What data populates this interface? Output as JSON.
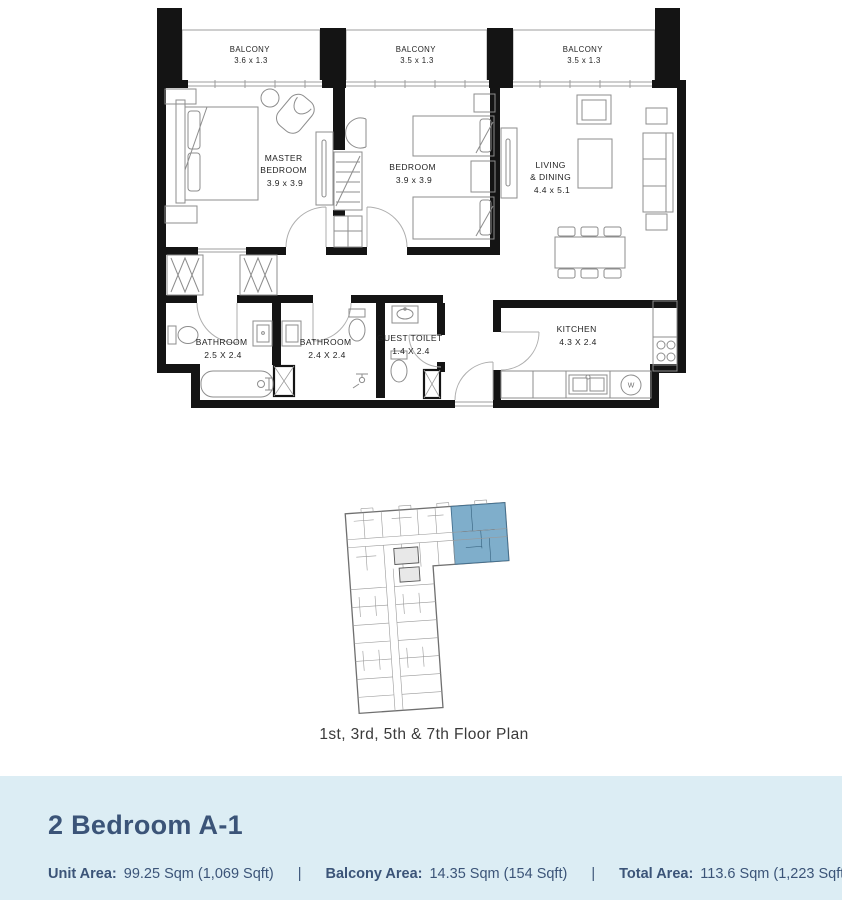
{
  "colors": {
    "footer_bg": "#DCEDF4",
    "navy": "#3B5478",
    "highlight": "#7FAECB",
    "wall": "#141414",
    "furniture": "#8D8D8D",
    "label": "#1F1F1F"
  },
  "floor_plan": {
    "balconies": [
      {
        "name": "BALCONY",
        "dim": "3.6 x 1.3"
      },
      {
        "name": "BALCONY",
        "dim": "3.5 x 1.3"
      },
      {
        "name": "BALCONY",
        "dim": "3.5 x 1.3"
      }
    ],
    "master_bedroom": {
      "line1": "MASTER",
      "line2": "BEDROOM",
      "dim": "3.9 x 3.9"
    },
    "bedroom": {
      "line1": "BEDROOM",
      "dim": "3.9 x 3.9"
    },
    "living": {
      "line1": "LIVING",
      "line2": "& DINING",
      "dim": "4.4 x 5.1"
    },
    "bathroom1": {
      "line1": "BATHROOM",
      "dim": "2.5 X 2.4"
    },
    "bathroom2": {
      "line1": "BATHROOM",
      "dim": "2.4 X 2.4"
    },
    "guest_toilet": {
      "line1": "GUEST TOILET",
      "dim": "1.4 X 2.4"
    },
    "kitchen": {
      "line1": "KITCHEN",
      "dim": "4.3 X 2.4"
    },
    "washer_label": "W"
  },
  "key_plan": {
    "caption": "1st, 3rd, 5th & 7th Floor Plan"
  },
  "footer": {
    "title": "2 Bedroom A-1",
    "separator": "|",
    "areas": [
      {
        "label": "Unit Area:",
        "value": "99.25 Sqm (1,069 Sqft)"
      },
      {
        "label": "Balcony Area:",
        "value": "14.35 Sqm (154 Sqft)"
      },
      {
        "label": "Total Area:",
        "value": "113.6 Sqm (1,223 Sqft)"
      }
    ]
  }
}
